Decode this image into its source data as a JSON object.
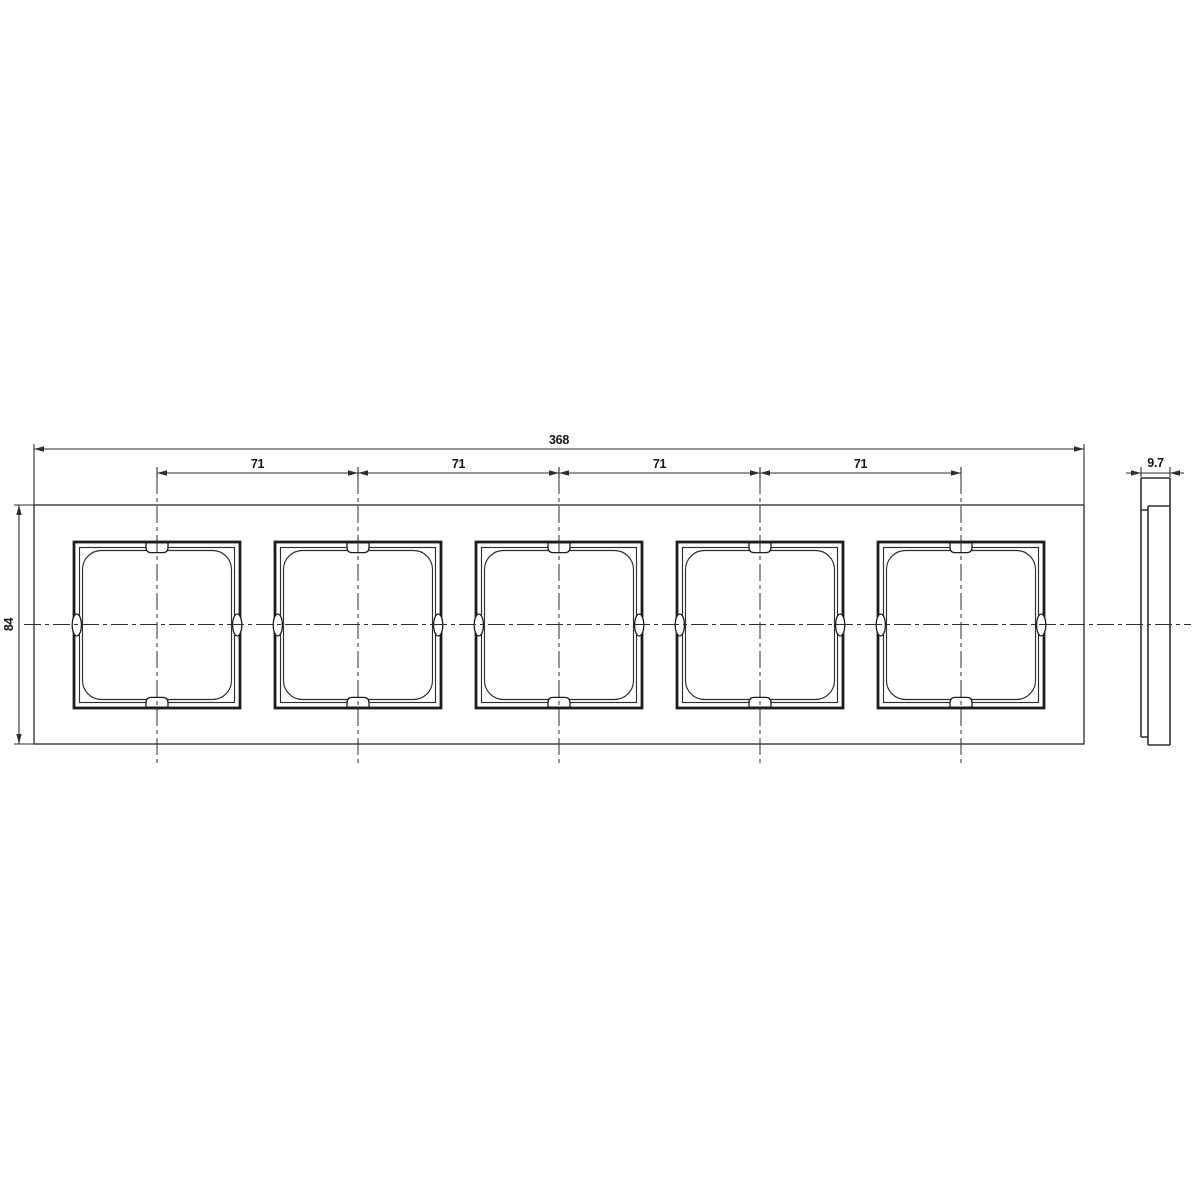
{
  "drawing": {
    "dimensions": {
      "total_width": "368",
      "pitch_1": "71",
      "pitch_2": "71",
      "pitch_3": "71",
      "pitch_4": "71",
      "height": "84",
      "depth": "9.7"
    },
    "colors": {
      "line": "#2e2e2e",
      "thick_line": "#1d1d1d",
      "background": "#ffffff"
    }
  }
}
